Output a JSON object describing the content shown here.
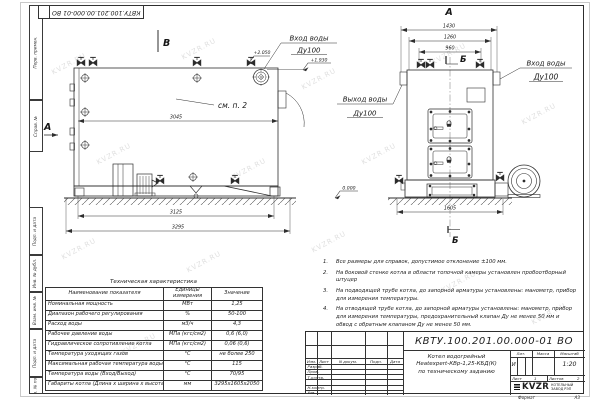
{
  "watermark": {
    "text": "KVZR.RU"
  },
  "frame": {
    "top_stamp": "КВТУ.100.201.00.000-01  ВО",
    "margin_boxes": [
      "Перв. примен.",
      "Справ. №",
      "Подп. и дата",
      "Инв. № дубл.",
      "Взам. инв. №",
      "Подп. и дата",
      "Инв. № подл."
    ],
    "format_label": "Формат",
    "format_value": "А3"
  },
  "side_view": {
    "view_label": "В",
    "arrow_label": "А",
    "see_note": "см. п. 2",
    "dims": {
      "width_body": "3045",
      "width_base": "3125",
      "width_total": "3295"
    },
    "elevations": {
      "top": "+2.050",
      "inlet": "+1.930",
      "ground": "0.000"
    },
    "inlet_label": "Вход воды",
    "inlet_dn": "Ду100",
    "outlet_label": "Выход воды",
    "outlet_dn": "Ду100"
  },
  "front_view": {
    "view_label": "А",
    "section_label_top": "Б",
    "section_label_bottom": "Б",
    "dims": {
      "width_total": "1430",
      "width_mid": "1260",
      "width_inner": "960",
      "width_base": "1605"
    },
    "inlet_label": "Вход воды",
    "inlet_dn": "Ду100"
  },
  "notes": [
    {
      "num": "1.",
      "text": "Все размеры для справок, допустимое отклонение ±100 мм."
    },
    {
      "num": "2.",
      "text": "На боковой стенке котла в области топочной камеры установлен пробоотборный штуцер"
    },
    {
      "num": "3.",
      "text": "На подводящей трубе котла, до запорной арматуры установлены: манометр, прибор для измерения температуры."
    },
    {
      "num": "4.",
      "text": "На отводящей трубе котла, до запорной арматуры установлены: манометр, прибор для измерения температуры, предохранительный клапан Ду не менее 50 мм и обвод с обратным клапаном Ду не менее 50 мм."
    }
  ],
  "spec_table": {
    "title": "Техническая характеристика",
    "headers": [
      "Наименование показателя",
      "Единицы измерения",
      "Значение"
    ],
    "rows": [
      {
        "name": "Номинальная мощность",
        "unit": "МВт",
        "value": "1,25"
      },
      {
        "name": "Диапазон рабочего регулирования",
        "unit": "%",
        "value": "50-100"
      },
      {
        "name": "Расход воды",
        "unit": "м3/ч",
        "value": "4,3"
      },
      {
        "name": "Рабочее давление воды",
        "unit": "МПа (кгс/см2)",
        "value": "0,6 (6,0)"
      },
      {
        "name": "Гидравлическое сопротивление котла",
        "unit": "МПа (кгс/см2)",
        "value": "0,06 (0,6)"
      },
      {
        "name": "Температура уходящих газов",
        "unit": "°С",
        "value": "не более 250"
      },
      {
        "name": "Максимальная рабочая температура воды",
        "unit": "°С",
        "value": "115"
      },
      {
        "name": "Температура воды (Вход/Выход)",
        "unit": "°С",
        "value": "70/95"
      },
      {
        "name": "Габариты котла (Длина х ширина х высота)",
        "unit": "мм",
        "value": "3295х1605х2050"
      }
    ]
  },
  "title_block": {
    "doc_number": "КВТУ.100.201.00.000-01 ВО",
    "product_line1": "Котел водогрейный",
    "product_line2": "Heatexpert-КВр-1,25-КБД(К)",
    "product_line3": "по техническому заданию",
    "header_cells": [
      "Изм.",
      "Лист",
      "N докум.",
      "Подп.",
      "Дата"
    ],
    "roles": [
      "Разраб.",
      "Пров.",
      "Т.контр.",
      "Н.контр.",
      "Утв."
    ],
    "lit_label": "Лит.",
    "mass_label": "Масса",
    "scale_label": "Масштаб",
    "lit_value": "И",
    "scale_value": "1:20",
    "sheet_label": "Лист",
    "sheet_value": "1",
    "sheets_label": "Листов",
    "sheets_value": "2",
    "logo_text": "KVZR",
    "company_line1": "КОТЕЛЬНЫЙ",
    "company_line2": "ЗАВОД РЭП"
  }
}
